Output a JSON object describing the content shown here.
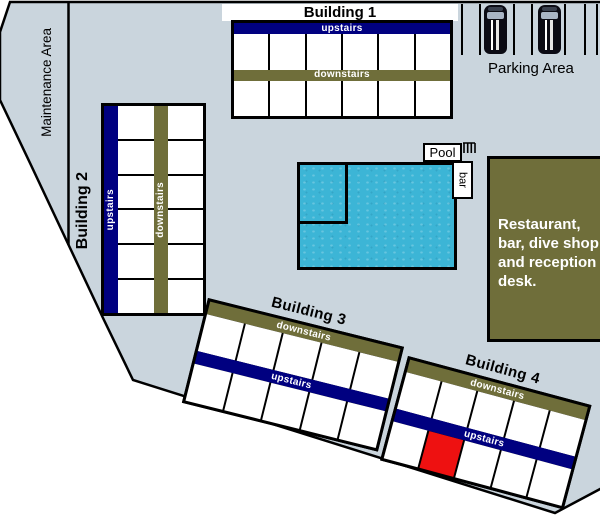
{
  "labels": {
    "maintenance": "Maintenance Area",
    "parking": "Parking Area",
    "pool": "Pool",
    "pool_bar": "bar"
  },
  "buildings": {
    "b1": {
      "label": "Building 1",
      "top_strip": "upstairs",
      "bottom_strip": "downstairs",
      "cells_per_row": 6
    },
    "b2": {
      "label": "Building 2",
      "left_strip": "upstairs",
      "right_strip": "downstairs",
      "rows": 6
    },
    "b3": {
      "label": "Building 3",
      "top_strip": "downstairs",
      "bottom_strip": "upstairs",
      "cells_per_row": 5
    },
    "b4": {
      "label": "Building 4",
      "top_strip": "downstairs",
      "bottom_strip": "upstairs",
      "cells_per_row": 5,
      "highlighted_cell_index": 1
    }
  },
  "restaurant_lines": [
    "Restaurant,",
    "bar, dive shop",
    "and reception",
    "desk."
  ],
  "icons": {
    "car": "car-icon",
    "pool_steps": "pool-steps-icon"
  },
  "colors": {
    "site": "#cad5dd",
    "navy": "#000080",
    "olive": "#6f6e3a",
    "pool_water": "#3cb5d6",
    "highlight": "#ee1111",
    "outline": "#000000"
  }
}
